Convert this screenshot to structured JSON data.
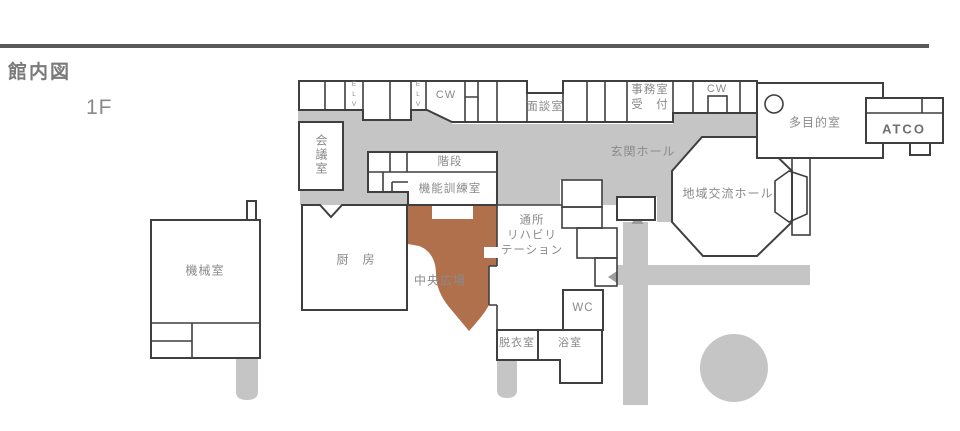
{
  "page": {
    "title": "館内図",
    "floor": "1F"
  },
  "colors": {
    "top_bar": "#595a5c",
    "corridor": "#c5c5c5",
    "accent_brown": "#b1704c",
    "wall": "#3f3f3f",
    "label": "#8a8a8a",
    "arrow": "#9c9c9c"
  },
  "rooms": {
    "kikaishitsu": "機械室",
    "kaigishitsu": "会議室",
    "elv": "E\nL\nV",
    "cw": "CW",
    "mendanshitsu": "面談室",
    "jimushitsu": "事務室\n受　付",
    "kaidan": "階段",
    "kinoukunren": "機能訓練室",
    "chuubou": "厨　房",
    "chuohiroba": "中央広場",
    "tsuushoriha": "通所\nリハビリ\nテーション",
    "wc": "WC",
    "datsuishitsu": "脱衣室",
    "yokushitsu": "浴室",
    "genkan": "玄関ホール",
    "chiikikouryu": "地域交流ホール",
    "tamokuteki": "多目的室"
  },
  "logo": {
    "label": "ATCO"
  }
}
